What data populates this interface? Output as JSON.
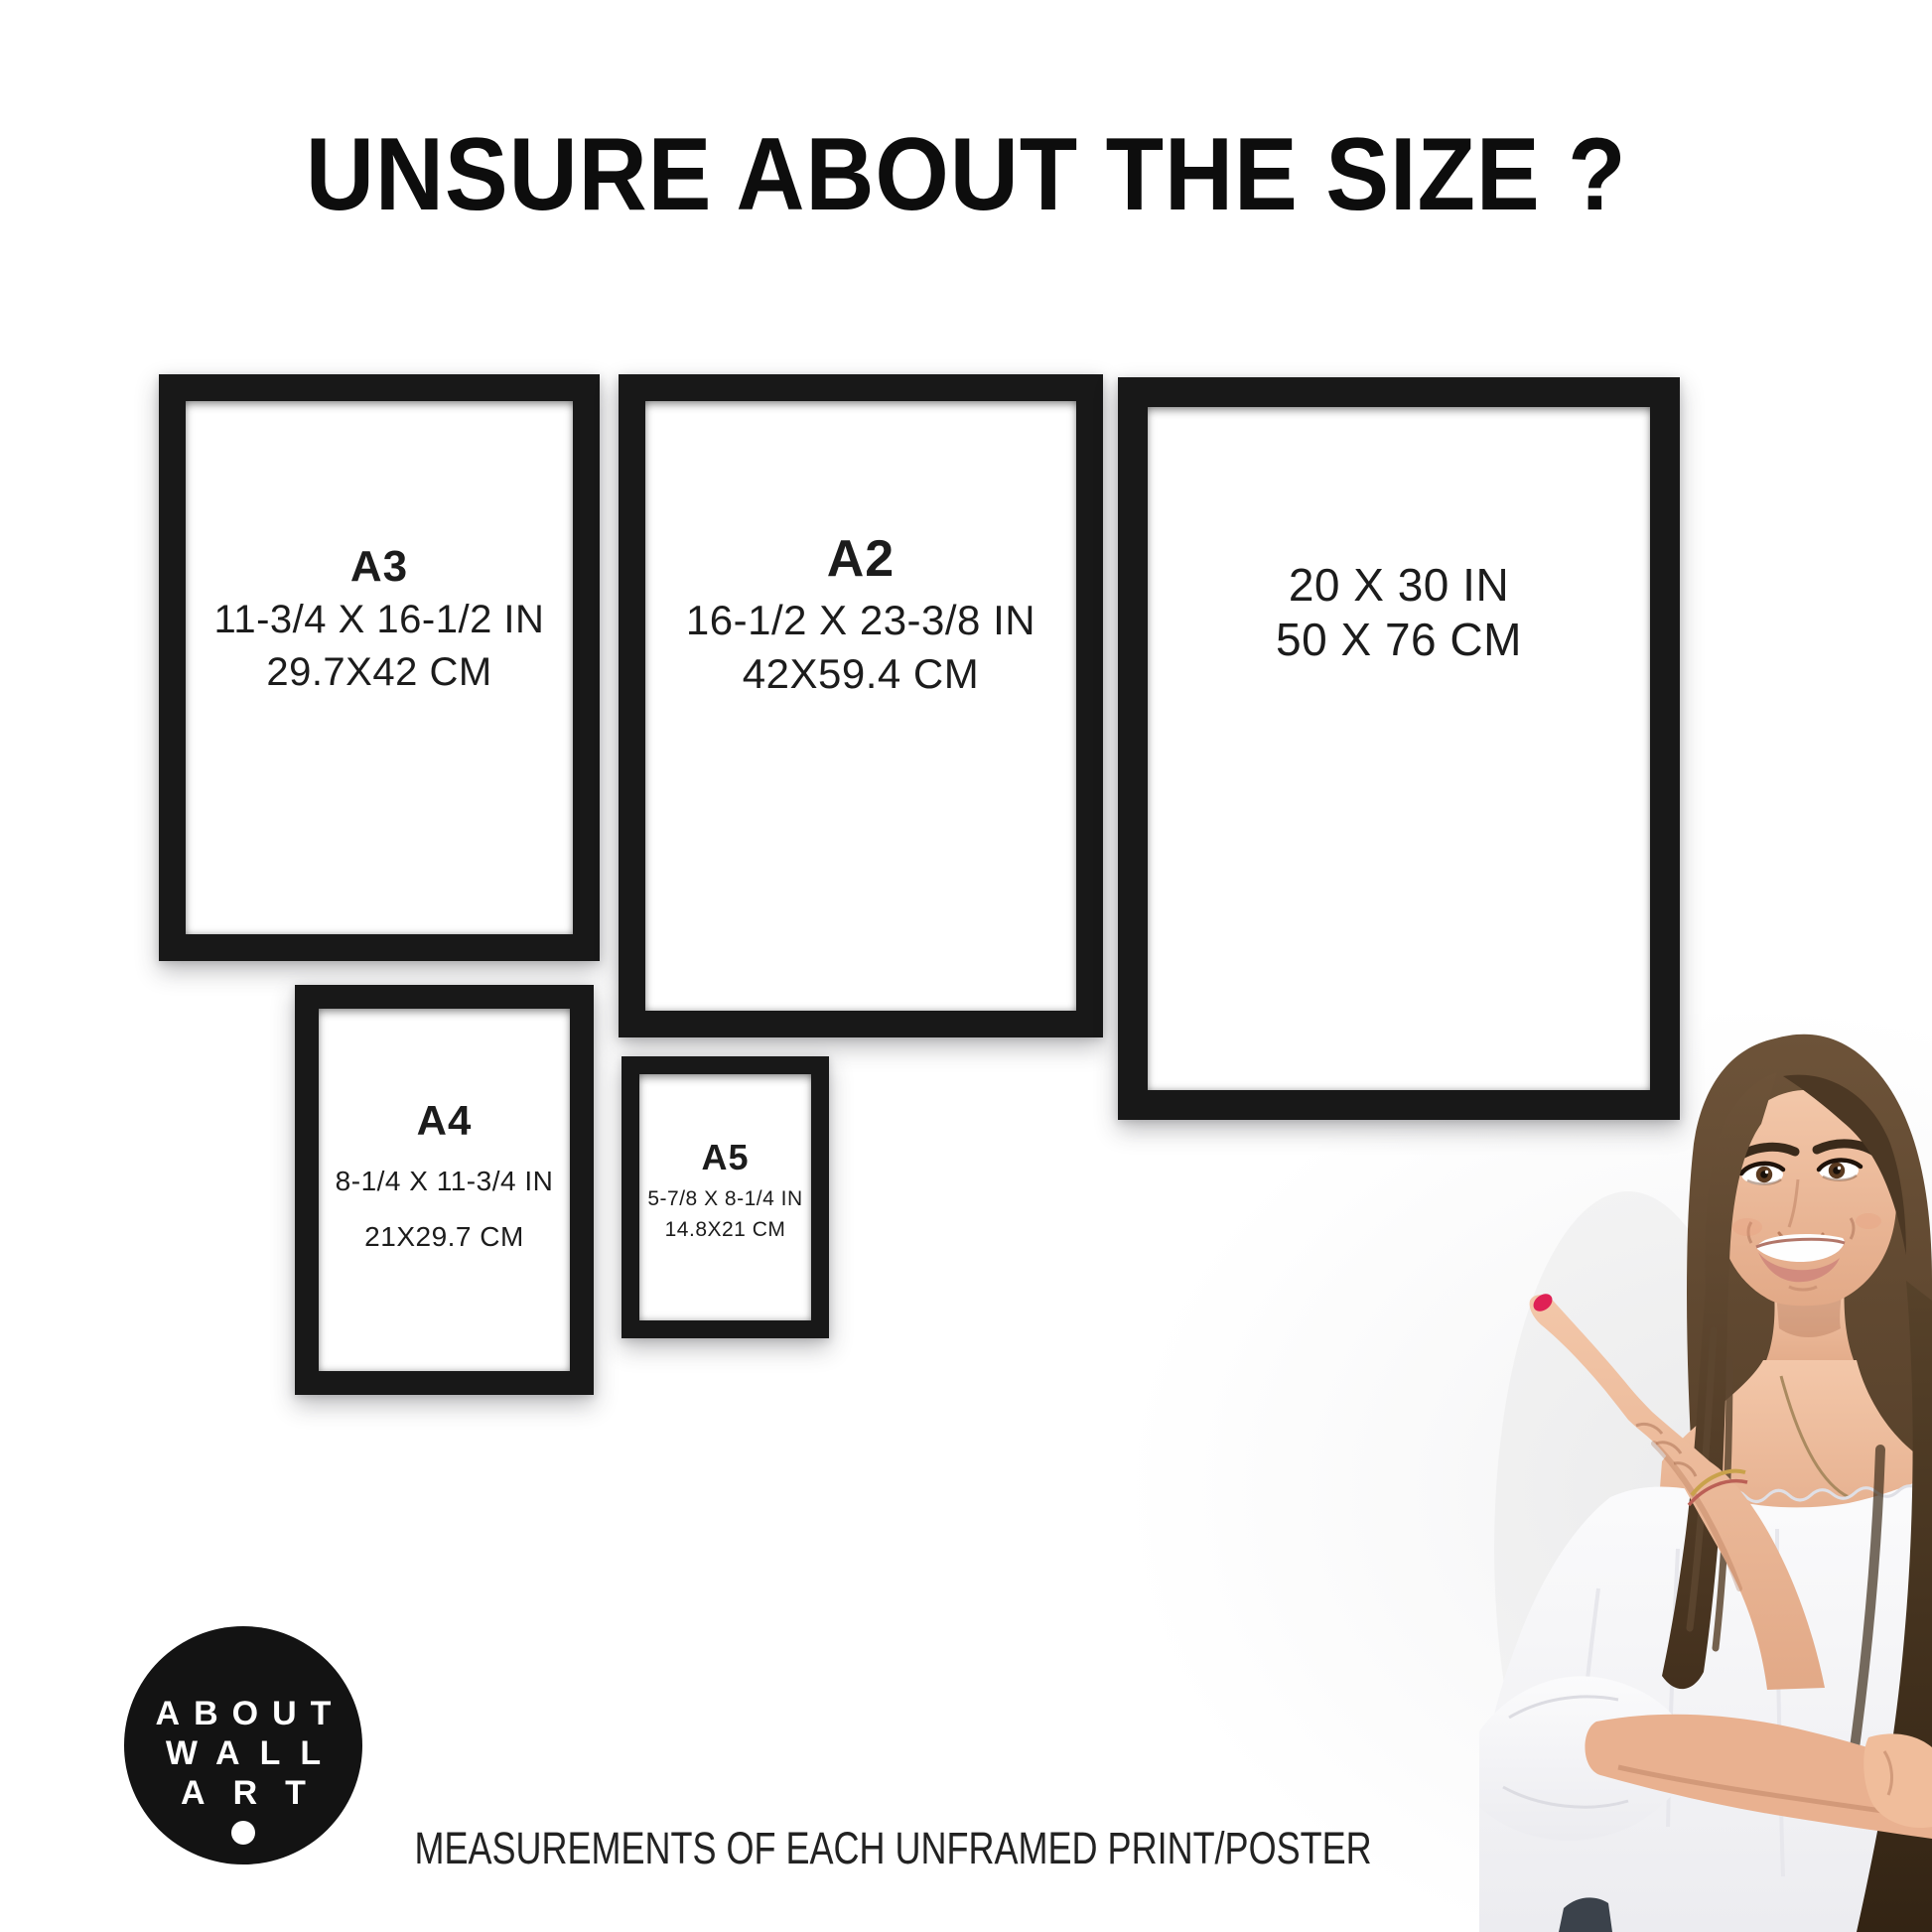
{
  "title": "UNSURE ABOUT THE SIZE ?",
  "frames": [
    {
      "id": "a3",
      "label": "A3",
      "inches": "11-3/4 X 16-1/2 IN",
      "cm": "29.7X42 CM"
    },
    {
      "id": "a2",
      "label": "A2",
      "inches": "16-1/2 X 23-3/8 IN",
      "cm": "42X59.4 CM"
    },
    {
      "id": "20x30",
      "label": "",
      "inches": "20 X 30 IN",
      "cm": "50 X 76 CM"
    },
    {
      "id": "a4",
      "label": "A4",
      "inches": "8-1/4 X 11-3/4 IN",
      "cm": "21X29.7 CM"
    },
    {
      "id": "a5",
      "label": "A5",
      "inches": "5-7/8 X 8-1/4 IN",
      "cm": "14.8X21 CM"
    }
  ],
  "logo": {
    "lines": [
      "ABOUT",
      "WALL",
      "ART"
    ]
  },
  "footer": "MEASUREMENTS OF EACH UNFRAMED PRINT/POSTER",
  "images": {
    "model": "woman-pointing-left"
  },
  "colors": {
    "frame_black": "#181818",
    "logo_black": "#131313",
    "text_black": "#1b1b1b",
    "background": "#ffffff",
    "nail_red": "#df2155",
    "hair_brown": "#55402c",
    "skin": "#eeb997",
    "blouse_white": "#f7f7f9"
  }
}
